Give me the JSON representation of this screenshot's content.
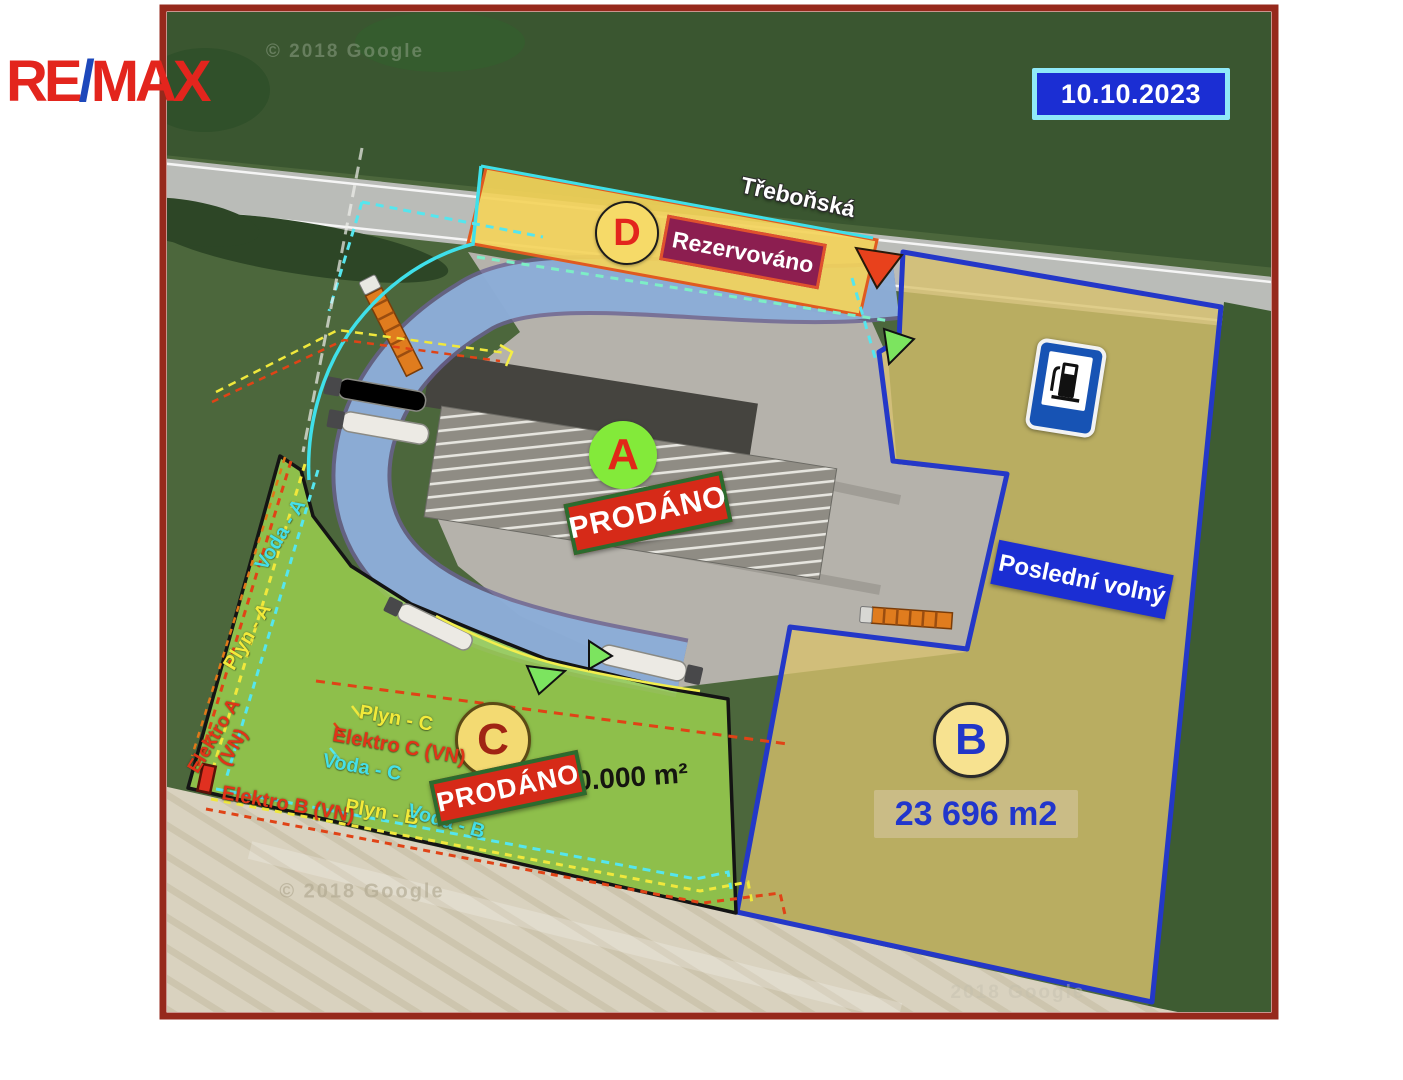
{
  "branding": {
    "re": "RE",
    "slash": "/",
    "max": "MAX"
  },
  "date_badge": {
    "text": "10.10.2023"
  },
  "map": {
    "street": "Třeboňská",
    "watermark_top": "© 2018 Google",
    "watermark_bottom_left": "© 2018 Google",
    "watermark_bottom_right": "2018 Google"
  },
  "zones": {
    "a": {
      "letter": "A",
      "status": "PRODÁNO"
    },
    "b": {
      "letter": "B",
      "area": "23 696 m2",
      "note": "Poslední volný"
    },
    "c": {
      "letter": "C",
      "status": "PRODÁNO",
      "area_visible": "0.000 m²"
    },
    "d": {
      "letter": "D",
      "status": "Rezervováno"
    }
  },
  "utilities": {
    "voda_a": "Voda - A",
    "plyn_a": "Plyn - A",
    "elektro_a": "Elektro A (VN)",
    "plyn_c": "Plyn - C",
    "elektro_c": "Elektro C (VN)",
    "voda_c": "Voda - C",
    "elektro_b": "Elektro B (VN)",
    "plyn_b": "Plyn - B",
    "voda_b": "Voda - B"
  },
  "colors": {
    "frame_maroon": "#96291c",
    "badge_blue": "#1b2ed3",
    "badge_border_cyan": "#8fe9f8",
    "sold_red": "#d62a18",
    "sold_border_green": "#2c6b2e",
    "reserved_magenta": "#8c1e50",
    "reserved_border": "#e0512d",
    "zone_b_border_blue": "#2438c8",
    "zone_c_fill_green": "#9ed34e",
    "zone_d_fill_yellow": "#f3d35a",
    "road_overlay_blue": "#8fb4dd",
    "utility_water_cyan": "#45e0e8",
    "utility_gas_yellow": "#f2ea3a",
    "utility_electric_red": "#e03418",
    "logo_red": "#e3251d",
    "logo_blue": "#1d48bb"
  }
}
